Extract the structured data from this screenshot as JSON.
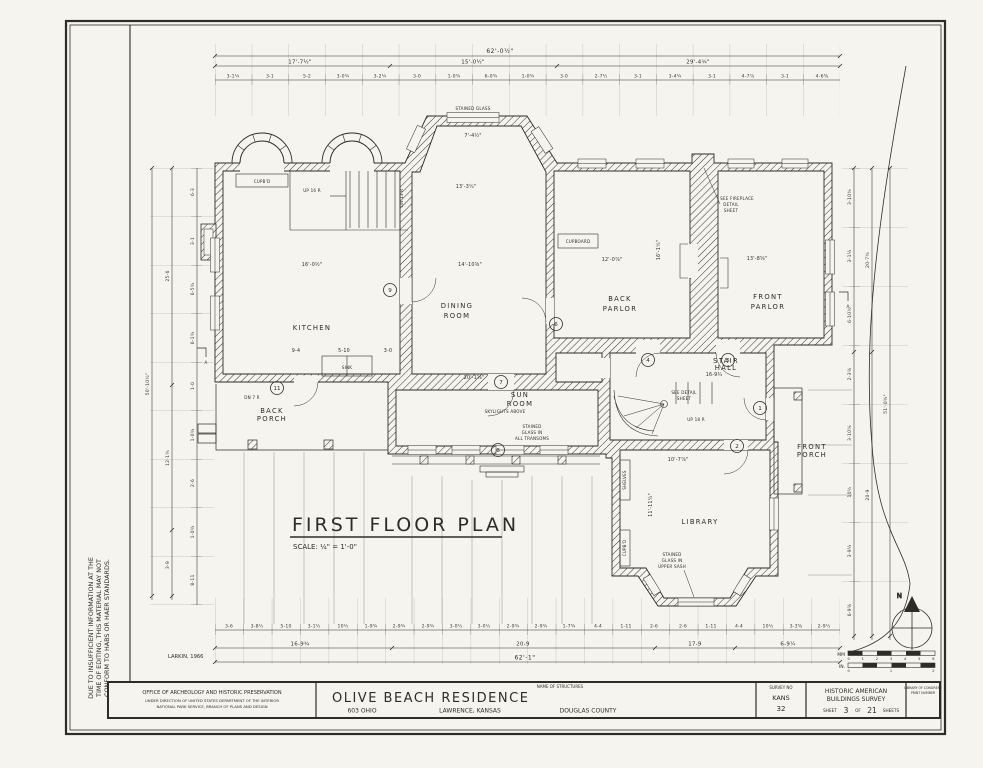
{
  "sheet": {
    "disclaimer": [
      "DUE TO INSUFFICIENT INFORMATION AT THE",
      "TIME OF EDITING, THIS MATERIAL MAY NOT",
      "CONFORM TO HABS OR HAER STANDARDS."
    ],
    "credit": "LARKIN, 1966"
  },
  "plan": {
    "title": "FIRST FLOOR PLAN",
    "scale_note": "SCALE: ¼\" = 1'-0\"",
    "north_label": "N",
    "rooms": {
      "kitchen": "KITCHEN",
      "dining": [
        "DINING",
        "ROOM"
      ],
      "back_parlor": [
        "BACK",
        "PARLOR"
      ],
      "front_parlor": [
        "FRONT",
        "PARLOR"
      ],
      "sun_room": [
        "SUN",
        "ROOM"
      ],
      "stair_hall": [
        "STAIR",
        "HALL"
      ],
      "library": "LIBRARY",
      "back_porch": [
        "BACK",
        "PORCH"
      ],
      "front_porch": [
        "FRONT",
        "PORCH"
      ]
    },
    "notes": {
      "stained_glass": "STAINED GLASS",
      "skylights": "SKYLIGHTS ABOVE",
      "transoms": [
        "STAINED",
        "GLASS IN",
        "ALL TRANSOMS"
      ],
      "fireplace": [
        "SEE FIREPLACE",
        "DETAIL",
        "SHEET"
      ],
      "stair_detail": [
        "SEE DETAIL",
        "SHEET"
      ],
      "upper_sash": [
        "STAINED",
        "GLASS IN",
        "UPPER SASH"
      ],
      "cupboard1": "CUPB'D",
      "cupboard2": "CUPBOARD",
      "shelves": "SHELVES",
      "cupboard3": "CUPB'D",
      "sink": "SINK",
      "up16": "UP 16 R",
      "up18": "UP 18 R",
      "dn13": "DN 13 R",
      "dn7": "DN 7 R",
      "section_a": "A"
    },
    "markers": {
      "m1": "1",
      "m2": "2",
      "m4": "4",
      "m5": "5",
      "m6": "6",
      "m7": "7",
      "m8": "8",
      "m9": "9",
      "m11": "11"
    },
    "dims": {
      "top_overall": "62'-0½\"",
      "top_mid": [
        "17'-7½\"",
        "15'-0½\"",
        "29'-4¾\""
      ],
      "top_small": [
        "3-1¼",
        "3-1",
        "5-2",
        "3-0¾",
        "3-2¼",
        "3-0",
        "1-0¾",
        "6-0¾",
        "1-0¾",
        "3-0",
        "2-7½",
        "3-1",
        "3-4¼",
        "3-1",
        "4-7⅞",
        "3-1",
        "4-6⅝"
      ],
      "bottom_small": [
        "3-6",
        "3-8½",
        "5-10",
        "3-1½",
        "10½",
        "1-9¾",
        "2-9¾",
        "2-9¾",
        "3-0½",
        "3-0½",
        "2-9¾",
        "2-9¾",
        "1-7¾",
        "4-4",
        "1-11",
        "2-6",
        "2-6",
        "1-11",
        "4-4",
        "10½",
        "3-3⅝",
        "2-9½"
      ],
      "bottom_mid": [
        "16-9¾",
        "20-9",
        "17-9",
        "6-9¼"
      ],
      "bottom_overall": "62'-1\"",
      "left_small": [
        "6-3",
        "3-1",
        "6-5¾",
        "6-1¾",
        "1-0",
        "1-0¾",
        "2-6",
        "1-0¾",
        "8-11"
      ],
      "left_mid": [
        "25-6",
        "12-1¾",
        "3-9"
      ],
      "left_overall": "50'-10½\"",
      "right_small": [
        "3-10¾",
        "3-1¼",
        "6-10½",
        "2-3⅝",
        "3-10⅝",
        "10½",
        "3-9¼",
        "6-9⅝"
      ],
      "right_mid": [
        "20-7¾",
        "20-9"
      ],
      "right_overall": "51'-0¾\"",
      "interior": {
        "kitchen_w": "16'-0½\"",
        "kitchen_a": "9-4",
        "kitchen_b": "5-10",
        "kitchen_c": "3-0",
        "dining_w": "14'-10⅝\"",
        "bay_w": "13'-3¼\"",
        "bay_win": "7'-4½\"",
        "back_parlor_w": "12'-0⅞\"",
        "front_parlor_w": "13'-8⅝\"",
        "parlor_d": "16'-1¼\"",
        "sun_w": "20'-1⅝\"",
        "hall_w": "16-9¾",
        "library_w": "10'-7⅞\"",
        "library_d": "11'-11¼\""
      }
    },
    "scalebar": {
      "metric_label": "MM",
      "imperial_label": "IN.",
      "metric_ticks": "0  1  2  3  4  5  6",
      "imperial_ticks": "0    1    2"
    }
  },
  "titleblock": {
    "name_label": "NAME OF STRUCTURES",
    "office": [
      "OFFICE OF ARCHEOLOGY AND HISTORIC PRESERVATION",
      "UNDER DIRECTION OF UNITED STATES DEPARTMENT OF THE INTERIOR",
      "NATIONAL PARK SERVICE, BRANCH OF PLANS AND DESIGN"
    ],
    "structure": "OLIVE BEACH RESIDENCE",
    "address": "603 OHIO",
    "city": "LAWRENCE, KANSAS",
    "county": "DOUGLAS COUNTY",
    "survey_label": "SURVEY NO",
    "survey_state": "KANS",
    "survey_number": "32",
    "habs": [
      "HISTORIC AMERICAN",
      "BUILDINGS SURVEY"
    ],
    "sheet_label": "SHEET",
    "sheet_number": "3",
    "of_label": "OF",
    "sheet_total": "21",
    "sheets_label": "SHEETS",
    "loc": [
      "LIBRARY OF CONGRESS",
      "PRINT NUMBER"
    ]
  }
}
